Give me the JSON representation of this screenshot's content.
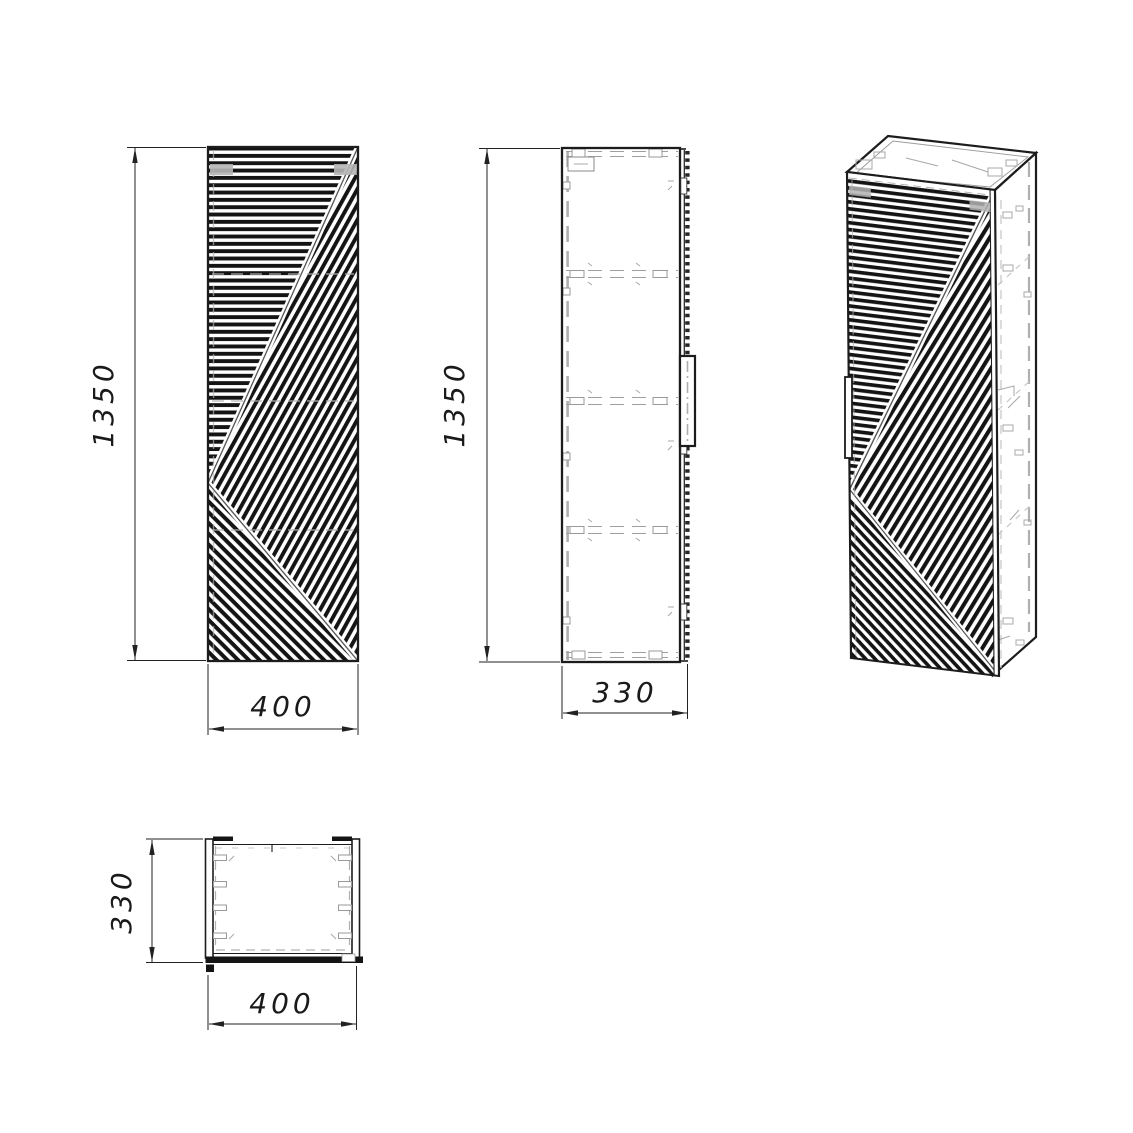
{
  "colors": {
    "line": "#1c1c1c",
    "gray": "#a8a8a8",
    "background": "#ffffff"
  },
  "views": {
    "front": {
      "height": "1350",
      "width": "400"
    },
    "side": {
      "height": "1350",
      "depth": "330"
    },
    "top": {
      "depth": "330",
      "width": "400"
    }
  }
}
